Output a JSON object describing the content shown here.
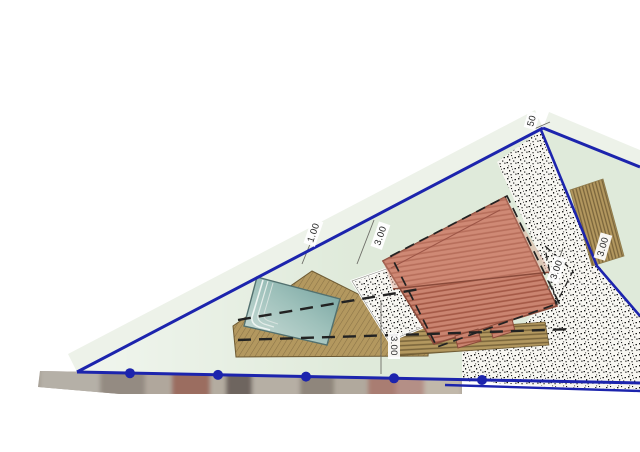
{
  "plan": {
    "title": "site-plan-drawing",
    "dimensions": {
      "top_small": "1.00",
      "top_building": "3.00",
      "right_inner": "3.00",
      "right_deck": "3.00",
      "bottom_deck": "3.00",
      "corner": "50"
    },
    "features": {
      "parcel": "triangular parcel with blue boundary",
      "building": "tiled-roof building",
      "pool": "swimming pool with steps",
      "deck": "wooden deck around pool",
      "deck_band": "wooden deck band below building",
      "deck_strip": "wooden deck strip at right boundary",
      "gravel": "gravel / stippled paving areas",
      "setbacks": "dashed setback lines",
      "survey_points": "boundary survey point markers",
      "photo_strip": "street-level photo strip along bottom boundary"
    },
    "colors": {
      "boundary_blue": "#1c24ad",
      "lot_green": "#dfeada",
      "roof_base": "#ca8470",
      "roof_stripe": "#a55a47",
      "deck_tan": "#b3985f",
      "deck_stripe": "#7c673c",
      "pool_dark": "#7fa9a6",
      "pool_light": "#cfdfda",
      "stipple_bg": "#f7f6f1",
      "dash_black": "#222222"
    }
  }
}
